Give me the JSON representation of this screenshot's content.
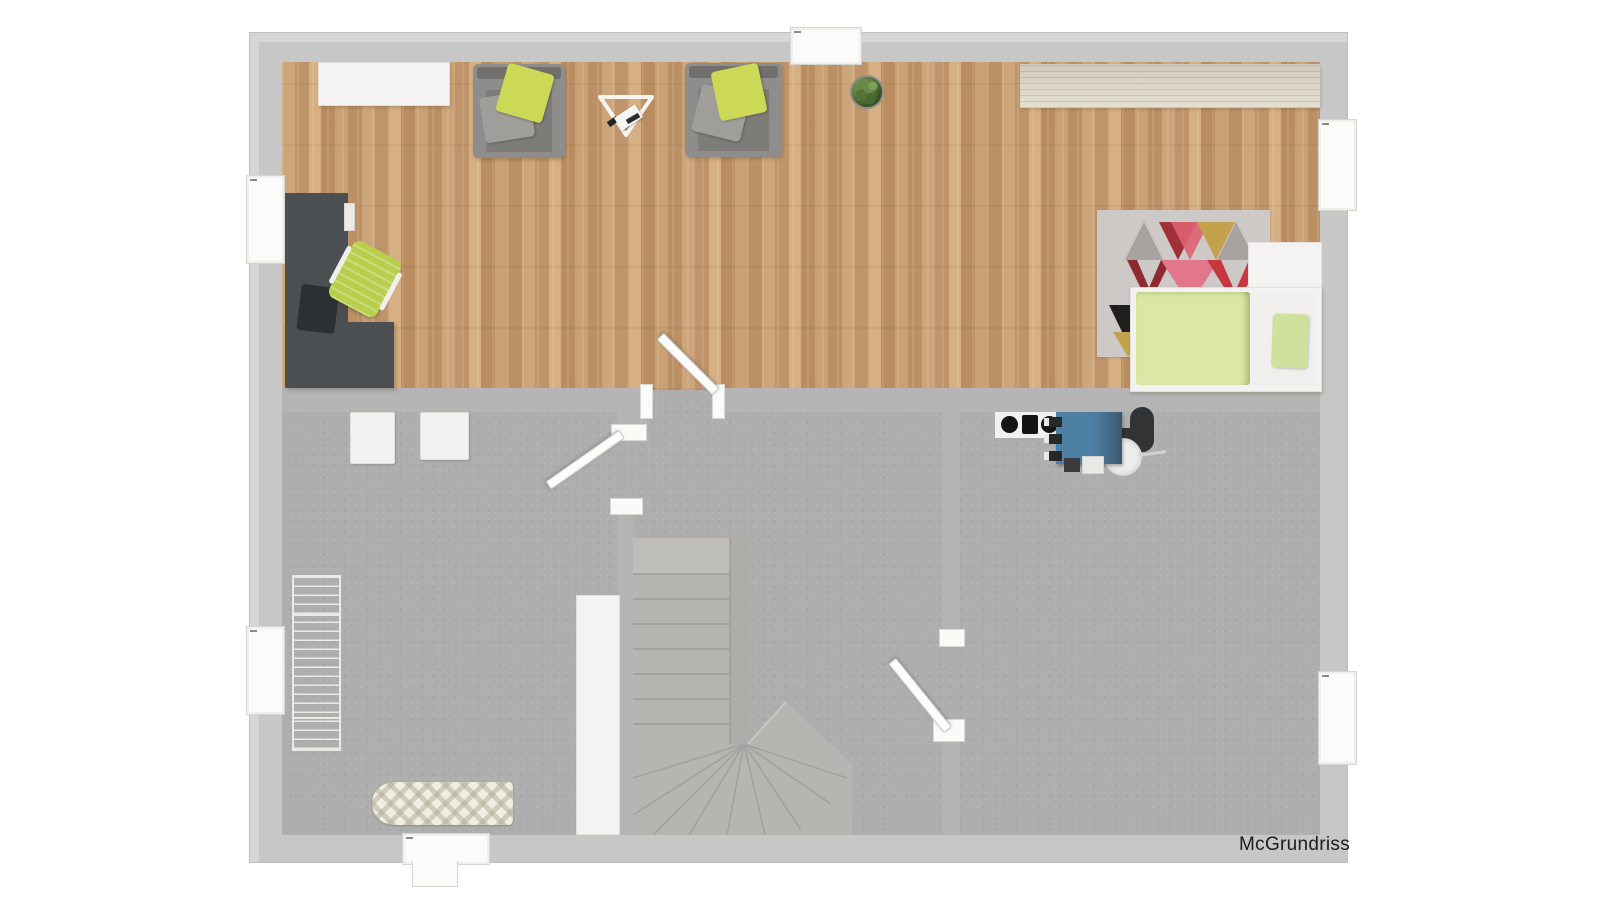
{
  "watermark": {
    "text": "McGrundriss"
  },
  "palette": {
    "outer-wall": "#c7c7c7",
    "inner-wall": "#b5b5b5",
    "wood-a": "#cda57a",
    "counter-wood": "#ddd5c5",
    "basement": "#aeaeae",
    "desk": "#4b4f51",
    "chair-green": "#b7cf4d",
    "pillow-green": "#ccd957",
    "duvet-green": "#dbe8a5",
    "stove-blue": "#4e80a6",
    "rug-base": "#cdc9c6"
  },
  "plan": {
    "upper_floor": "wood-parquet",
    "lower_floor": "concrete-screed",
    "windows_count": 6,
    "door_leaves_count": 3
  },
  "objects": {
    "living_area": [
      "sideboard",
      "armchair",
      "armchair",
      "music-stand",
      "potted-plant",
      "kitchen-counter",
      "corner-desk",
      "office-chair",
      "area-rug",
      "single-bed"
    ],
    "basement_area": [
      "white-cabinet",
      "white-cabinet",
      "drying-rack",
      "ironing-board",
      "wardrobe",
      "winder-staircase",
      "cooktop",
      "wood-stove",
      "stove-pipe",
      "pot"
    ]
  }
}
